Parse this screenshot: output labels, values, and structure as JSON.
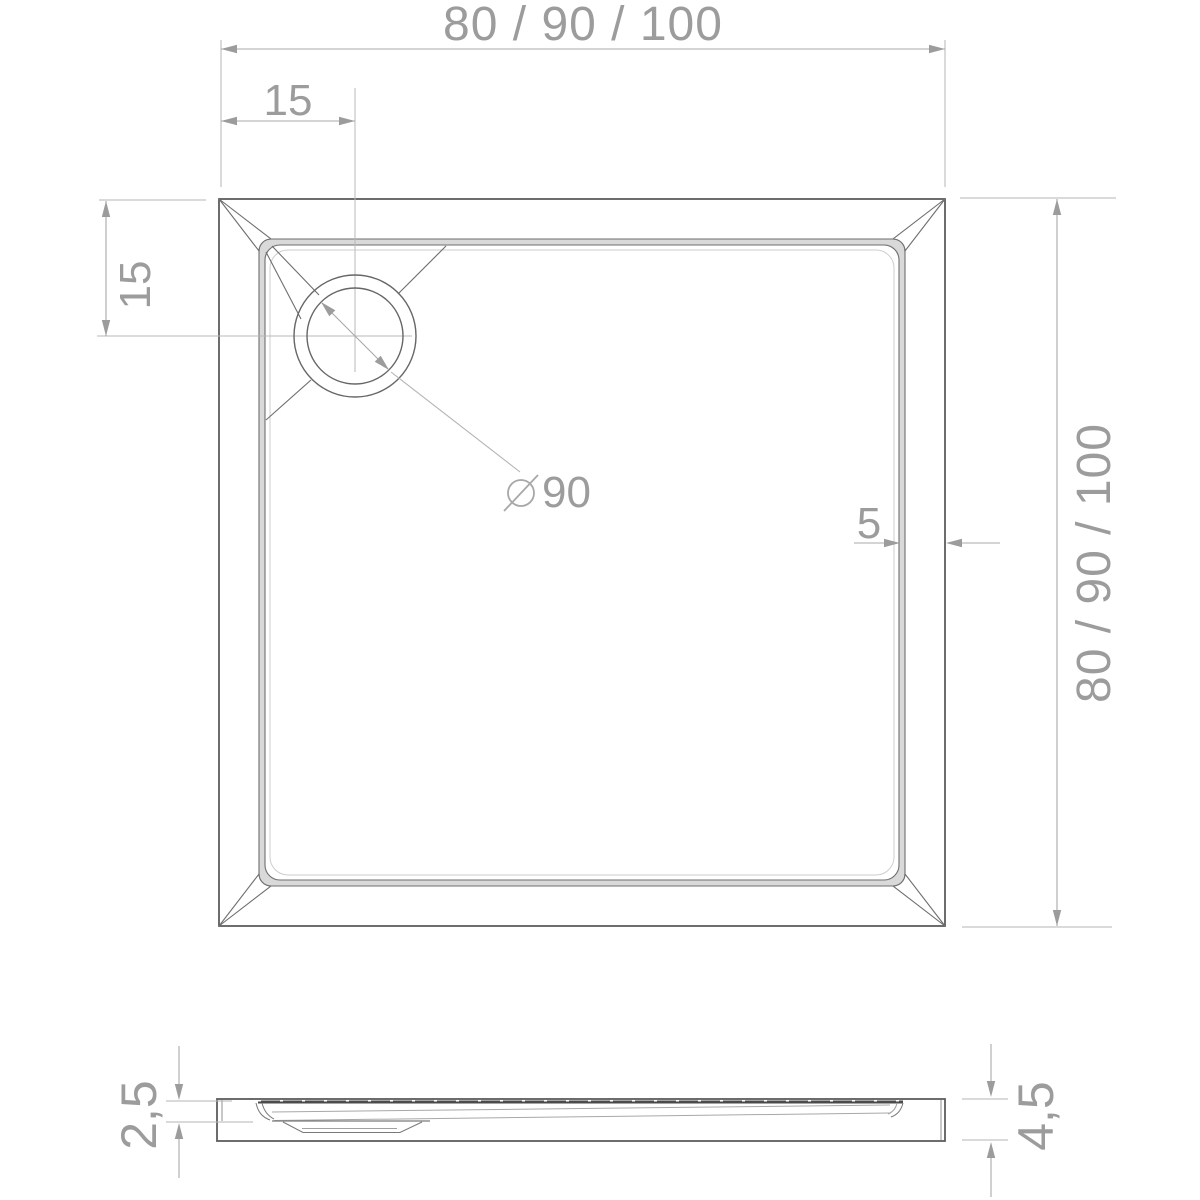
{
  "drawing": {
    "type": "shower-tray technical drawing",
    "views": {
      "top_view": "plan view with corner drain",
      "section_view": "side profile"
    }
  },
  "colors": {
    "background": "#ffffff",
    "object_line": "#5d5d5d",
    "detail_line": "#6e6e6e",
    "section_dark_line": "#4b4b4b",
    "rim_shading": "#d9d9d9",
    "dimension_line": "#a8a8a8",
    "extension_line": "#b4b4b4",
    "text": "#9c9c9c"
  },
  "top_view": {
    "dim_width_top": {
      "label": "80 / 90 / 100"
    },
    "dim_depth_right": {
      "label": "80 / 90 / 100"
    },
    "dim_drain_offset_x": {
      "label": "15"
    },
    "dim_drain_offset_y": {
      "label": "15"
    },
    "dim_wall_thickness": {
      "label": "5"
    },
    "dim_drain_diameter": {
      "symbol": "⌀",
      "value": "90"
    }
  },
  "section_view": {
    "dim_inner_depth": {
      "label": "2,5"
    },
    "dim_total_height": {
      "label": "4,5"
    }
  }
}
